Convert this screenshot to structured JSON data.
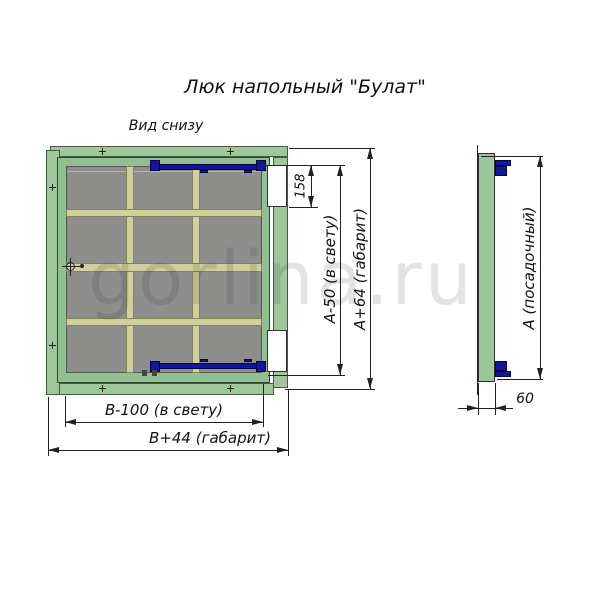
{
  "title": "Люк напольный \"Булат\"",
  "view_label": "Вид снизу",
  "watermark": "gorlina.ru",
  "dimensions": {
    "hinge_cutout_height": "158",
    "height_clear": "A-50 (в свету)",
    "height_overall": "A+64 (габарит)",
    "width_clear": "B-100 (в свету)",
    "width_overall": "B+44 (габарит)",
    "seat_height": "A (посадочный)",
    "profile_depth": "60"
  },
  "colors": {
    "frame_green": "#a0c69c",
    "lid_green": "#92bf90",
    "panel_gray": "#8e8f8d",
    "rib_tan": "#cfd09b",
    "hinge_blue": "#15159a",
    "drawing_line": "#1a1a1a",
    "watermark_gray": "#bdbdbd"
  },
  "icons": {
    "center_mark": "crosshair-circle",
    "screw_mark": "plus-cross"
  }
}
